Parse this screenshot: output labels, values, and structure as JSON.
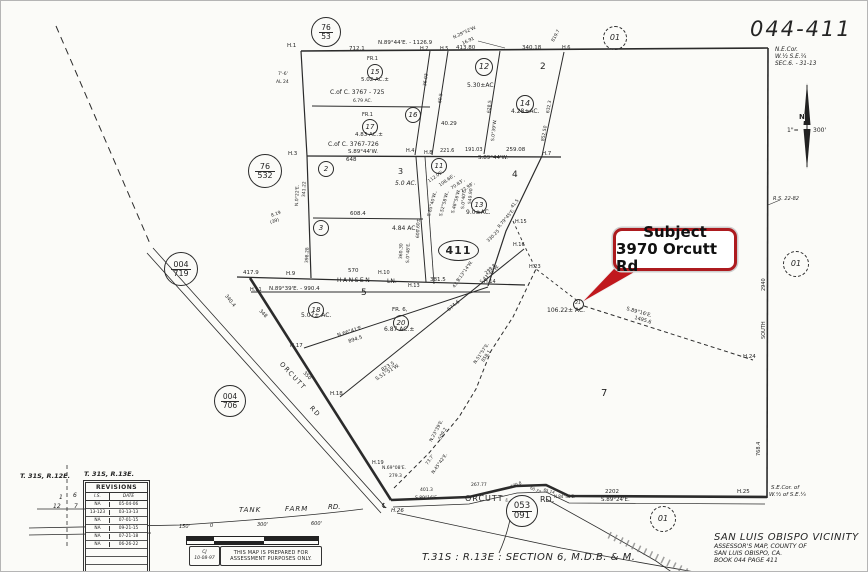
{
  "sheet": {
    "number": "044-411",
    "corner_note": [
      "N.E.Cor.",
      "W.½ S.E.¼",
      "SEC.6. - 31-13"
    ]
  },
  "callout": {
    "title": "Subject",
    "address": "3970 Orcutt Rd",
    "red": "#ad1b1f"
  },
  "index_oval": "411",
  "township": {
    "left": "T. 31S, R.12E.",
    "right": "T. 31S, R.13E."
  },
  "revisions": {
    "title": "REVISIONS",
    "columns": [
      "I.S.",
      "DATE"
    ],
    "rows": [
      [
        "NA",
        "05-04-06"
      ],
      [
        "13-123",
        "03-13-13"
      ],
      [
        "NA",
        "07-01-15"
      ],
      [
        "NA",
        "09-21-15"
      ],
      [
        "NA",
        "07-21-18"
      ],
      [
        "NA",
        "06-26-22"
      ]
    ],
    "empty_rows": 4
  },
  "scalebar": {
    "ticks": [
      "150'",
      "0",
      "300'",
      "600'"
    ]
  },
  "stamp": {
    "initials": "CJ",
    "date": "10-08-97",
    "line1": "THIS MAP IS PREPARED FOR",
    "line2": "ASSESSMENT PURPOSES ONLY."
  },
  "footer": {
    "section": "T.31S : R.13E : SECTION  6, M.D.B. & M.",
    "vicinity": "SAN LUIS OBISPO VICINITY",
    "sub1": "ASSESSOR'S MAP, COUNTY OF",
    "sub2": "SAN LUIS OBISPO, CA.",
    "sub3": "BOOK 044 PAGE 411"
  },
  "ref_circles": [
    {
      "a": "76",
      "b": "53",
      "x": 325,
      "y": 31,
      "d": 30,
      "f": 7.5
    },
    {
      "a": "76",
      "b": "532",
      "x": 264,
      "y": 170,
      "d": 34,
      "f": 8
    },
    {
      "a": "004",
      "b": "719",
      "x": 180,
      "y": 268,
      "d": 34,
      "f": 8
    },
    {
      "a": "004",
      "b": "706",
      "x": 229,
      "y": 400,
      "d": 32,
      "f": 7.5
    },
    {
      "a": "053",
      "b": "091",
      "x": 521,
      "y": 510,
      "d": 32,
      "f": 8.5,
      "fill": true
    },
    {
      "a": "01",
      "x": 614,
      "y": 37,
      "d": 24,
      "f": 8,
      "dash": true
    },
    {
      "a": "01",
      "x": 795,
      "y": 263,
      "d": 26,
      "f": 8,
      "dash": true
    },
    {
      "a": "01",
      "x": 662,
      "y": 518,
      "d": 26,
      "f": 8,
      "dash": true
    }
  ],
  "parcel_circles": [
    {
      "n": "15",
      "x": 374,
      "y": 71
    },
    {
      "n": "17",
      "x": 369,
      "y": 126
    },
    {
      "n": "16",
      "x": 412,
      "y": 114
    },
    {
      "n": "12",
      "x": 483,
      "y": 66,
      "d": 18,
      "f": 8
    },
    {
      "n": "14",
      "x": 524,
      "y": 103,
      "d": 18,
      "f": 8
    },
    {
      "n": "2",
      "x": 325,
      "y": 168
    },
    {
      "n": "3",
      "x": 320,
      "y": 227
    },
    {
      "n": "11",
      "x": 438,
      "y": 165
    },
    {
      "n": "13",
      "x": 478,
      "y": 204
    },
    {
      "n": "18",
      "x": 315,
      "y": 309
    },
    {
      "n": "20",
      "x": 400,
      "y": 322
    },
    {
      "n": "21",
      "x": 577,
      "y": 303,
      "d": 11,
      "f": 4.5
    }
  ],
  "map_labels": [
    {
      "t": "H.1",
      "x": 286,
      "y": 43,
      "s": 5.5
    },
    {
      "t": "712.1",
      "x": 348,
      "y": 46,
      "s": 5.5
    },
    {
      "t": "N.89°44'E. - 1126.9",
      "x": 377,
      "y": 40,
      "s": 5.5
    },
    {
      "t": "H.2",
      "x": 419,
      "y": 46,
      "s": 5
    },
    {
      "t": "H.5",
      "x": 439,
      "y": 46,
      "s": 5
    },
    {
      "t": "413.80",
      "x": 455,
      "y": 45,
      "s": 5.5
    },
    {
      "t": "340.18",
      "x": 521,
      "y": 45,
      "s": 5.5
    },
    {
      "t": "H.6",
      "x": 561,
      "y": 45,
      "s": 5
    },
    {
      "t": "N.29°52'W.",
      "x": 452,
      "y": 36,
      "r": -25,
      "s": 4.5
    },
    {
      "t": "16.91",
      "x": 461,
      "y": 42,
      "r": -25,
      "s": 4.5
    },
    {
      "t": "819.7",
      "x": 551,
      "y": 40,
      "r": -62,
      "s": 4.5
    },
    {
      "t": "7'-6'",
      "x": 277,
      "y": 72,
      "s": 4.5
    },
    {
      "t": "AL 24",
      "x": 275,
      "y": 80,
      "s": 4.5
    },
    {
      "t": "FR.1",
      "x": 366,
      "y": 56,
      "s": 5
    },
    {
      "t": "5.02 AC.±",
      "x": 360,
      "y": 77,
      "s": 5.5
    },
    {
      "t": "C.of C. 3767 - 725",
      "x": 329,
      "y": 89,
      "s": 6
    },
    {
      "t": "6.79 AC.",
      "x": 352,
      "y": 99,
      "s": 4.5
    },
    {
      "t": "FR.1",
      "x": 361,
      "y": 112,
      "s": 5
    },
    {
      "t": "4.83 AC.±",
      "x": 354,
      "y": 132,
      "s": 5.5
    },
    {
      "t": "C.of C. 3767-726",
      "x": 327,
      "y": 141,
      "s": 6
    },
    {
      "t": "S.89°44'W.",
      "x": 347,
      "y": 149,
      "s": 5.5
    },
    {
      "t": "648",
      "x": 345,
      "y": 157,
      "s": 5.5
    },
    {
      "t": "36.03",
      "x": 423,
      "y": 85,
      "r": -82,
      "s": 4.5
    },
    {
      "t": "60.5",
      "x": 438,
      "y": 102,
      "r": -82,
      "s": 4.5
    },
    {
      "t": "40.29",
      "x": 440,
      "y": 121,
      "s": 5.5
    },
    {
      "t": "5.30±AC.",
      "x": 466,
      "y": 82,
      "s": 6
    },
    {
      "t": "2",
      "x": 539,
      "y": 62,
      "s": 9
    },
    {
      "t": "4.28±AC.",
      "x": 510,
      "y": 108,
      "s": 6
    },
    {
      "t": "628.5",
      "x": 487,
      "y": 112,
      "r": -84,
      "s": 4.5
    },
    {
      "t": "S.0°39'W.",
      "x": 491,
      "y": 140,
      "r": -84,
      "s": 4.5
    },
    {
      "t": "632.3",
      "x": 546,
      "y": 112,
      "r": -80,
      "s": 4.5
    },
    {
      "t": "852.50",
      "x": 541,
      "y": 140,
      "r": -80,
      "s": 4.5
    },
    {
      "t": "H.3",
      "x": 287,
      "y": 151,
      "s": 5.5
    },
    {
      "t": "H.4",
      "x": 405,
      "y": 148,
      "s": 5
    },
    {
      "t": "H.8",
      "x": 423,
      "y": 150,
      "s": 5
    },
    {
      "t": "221.6",
      "x": 439,
      "y": 148,
      "s": 5
    },
    {
      "t": "191.03",
      "x": 464,
      "y": 147,
      "s": 5
    },
    {
      "t": "259.08",
      "x": 505,
      "y": 147,
      "s": 5.5
    },
    {
      "t": "H.7",
      "x": 541,
      "y": 151,
      "s": 5.5
    },
    {
      "t": "S.89°44'W.",
      "x": 477,
      "y": 155,
      "s": 5.5
    },
    {
      "t": "3",
      "x": 397,
      "y": 167,
      "s": 8
    },
    {
      "t": "5.0 AC.",
      "x": 394,
      "y": 180,
      "s": 6,
      "i": 1
    },
    {
      "t": "608.4",
      "x": 349,
      "y": 211,
      "s": 5.5
    },
    {
      "t": "4.84 AC.",
      "x": 391,
      "y": 225,
      "s": 6
    },
    {
      "t": "N.0°22'E.",
      "x": 295,
      "y": 205,
      "r": -88,
      "s": 4.5
    },
    {
      "t": "341.22",
      "x": 302,
      "y": 196,
      "r": -88,
      "s": 4.5
    },
    {
      "t": "398.28",
      "x": 305,
      "y": 262,
      "r": -88,
      "s": 4.5
    },
    {
      "t": "112.05',",
      "x": 427,
      "y": 180,
      "r": -35,
      "s": 4.5
    },
    {
      "t": "108.66',",
      "x": 438,
      "y": 184,
      "r": -35,
      "s": 4.5
    },
    {
      "t": "70.83',",
      "x": 450,
      "y": 187,
      "r": -35,
      "s": 4.5
    },
    {
      "t": "72.98',",
      "x": 460,
      "y": 190,
      "r": -35,
      "s": 4.5
    },
    {
      "t": "S.85°40'W.,",
      "x": 427,
      "y": 215,
      "r": -75,
      "s": 4.5
    },
    {
      "t": "S.52°58'W.,",
      "x": 439,
      "y": 215,
      "r": -75,
      "s": 4.5
    },
    {
      "t": "S.48°56'W.",
      "x": 451,
      "y": 212,
      "r": -75,
      "s": 4.5
    },
    {
      "t": "S.0°40'E.",
      "x": 461,
      "y": 208,
      "r": -85,
      "s": 4.5
    },
    {
      "t": "549.90",
      "x": 468,
      "y": 203,
      "r": -85,
      "s": 4.5
    },
    {
      "t": "600.60±",
      "x": 416,
      "y": 237,
      "r": -88,
      "s": 4.5
    },
    {
      "t": "360.30",
      "x": 399,
      "y": 258,
      "r": -88,
      "s": 4.5
    },
    {
      "t": "S.0°48'E.",
      "x": 406,
      "y": 262,
      "r": -88,
      "s": 4.5
    },
    {
      "t": "9.0±AC.",
      "x": 465,
      "y": 209,
      "s": 6
    },
    {
      "t": "4",
      "x": 511,
      "y": 170,
      "s": 9
    },
    {
      "t": "41.5",
      "x": 510,
      "y": 206,
      "r": -50,
      "s": 4.5
    },
    {
      "t": "R.79°45'E.",
      "x": 497,
      "y": 226,
      "r": -50,
      "s": 4.5
    },
    {
      "t": "330.25",
      "x": 486,
      "y": 240,
      "r": -45,
      "s": 4.5
    },
    {
      "t": "S.13°14'W.",
      "x": 456,
      "y": 280,
      "r": -55,
      "s": 4.5
    },
    {
      "t": "43.7'",
      "x": 452,
      "y": 286,
      "r": -55,
      "s": 4.5
    },
    {
      "t": "299.8",
      "x": 484,
      "y": 272,
      "r": -43,
      "s": 4.5
    },
    {
      "t": "S.43°49'W.",
      "x": 479,
      "y": 281,
      "r": -43,
      "s": 4.5
    },
    {
      "t": "H.15",
      "x": 514,
      "y": 219,
      "s": 5
    },
    {
      "t": "H.16",
      "x": 512,
      "y": 242,
      "s": 5
    },
    {
      "t": "H.23",
      "x": 528,
      "y": 264,
      "s": 5
    },
    {
      "t": "417.9",
      "x": 242,
      "y": 270,
      "s": 5.5
    },
    {
      "t": "H.9",
      "x": 285,
      "y": 271,
      "s": 5.5
    },
    {
      "t": "570",
      "x": 347,
      "y": 268,
      "s": 5.5
    },
    {
      "t": "H.10",
      "x": 377,
      "y": 270,
      "s": 5
    },
    {
      "t": "HANSEN",
      "x": 336,
      "y": 277,
      "s": 6,
      "sp": 1.5
    },
    {
      "t": "LN.",
      "x": 386,
      "y": 278,
      "s": 6
    },
    {
      "t": "381.5",
      "x": 429,
      "y": 277,
      "s": 5.5
    },
    {
      "t": "H.14",
      "x": 483,
      "y": 279,
      "s": 5
    },
    {
      "t": "H.13",
      "x": 407,
      "y": 283,
      "s": 5
    },
    {
      "t": "N.89°39'E. - 990.4",
      "x": 268,
      "y": 286,
      "s": 5.5
    },
    {
      "t": "H.11",
      "x": 249,
      "y": 287,
      "s": 5
    },
    {
      "t": "5",
      "x": 360,
      "y": 288,
      "s": 9
    },
    {
      "t": "5.07± AC.",
      "x": 300,
      "y": 312,
      "s": 6
    },
    {
      "t": "FR. 6,",
      "x": 391,
      "y": 307,
      "s": 5.5
    },
    {
      "t": "6.87 AC.±",
      "x": 383,
      "y": 326,
      "s": 6
    },
    {
      "t": "N.66°41'E.",
      "x": 336,
      "y": 333,
      "r": -18,
      "s": 5
    },
    {
      "t": "894.5",
      "x": 347,
      "y": 339,
      "r": -18,
      "s": 5
    },
    {
      "t": "823.5",
      "x": 380,
      "y": 368,
      "r": -32,
      "s": 5
    },
    {
      "t": "S.51°51'W.",
      "x": 374,
      "y": 377,
      "r": -32,
      "s": 5
    },
    {
      "t": "674.6",
      "x": 446,
      "y": 308,
      "r": -40,
      "s": 5
    },
    {
      "t": "H.17",
      "x": 289,
      "y": 343,
      "s": 5.5
    },
    {
      "t": "H.18",
      "x": 329,
      "y": 391,
      "s": 5.5
    },
    {
      "t": "350",
      "x": 304,
      "y": 370,
      "r": 46,
      "s": 5
    },
    {
      "t": "348",
      "x": 260,
      "y": 308,
      "r": 46,
      "s": 5
    },
    {
      "t": "340.4",
      "x": 226,
      "y": 293,
      "r": 52,
      "s": 5
    },
    {
      "t": "ORCUTT",
      "x": 282,
      "y": 360,
      "r": 47,
      "s": 6.5,
      "sp": 1.5
    },
    {
      "t": "RD",
      "x": 312,
      "y": 404,
      "r": 47,
      "s": 6.5,
      "sp": 1.5
    },
    {
      "t": "106.22± AC.",
      "x": 546,
      "y": 307,
      "s": 6
    },
    {
      "t": "S.89°16'E.",
      "x": 626,
      "y": 306,
      "r": 16,
      "s": 5
    },
    {
      "t": "1495.6",
      "x": 634,
      "y": 315,
      "r": 16,
      "s": 5
    },
    {
      "t": "H.24",
      "x": 742,
      "y": 354,
      "s": 5.5
    },
    {
      "t": "7",
      "x": 600,
      "y": 388,
      "s": 10
    },
    {
      "t": "2940",
      "x": 761,
      "y": 290,
      "r": -90,
      "s": 5
    },
    {
      "t": "SOUTH",
      "x": 761,
      "y": 338,
      "r": -90,
      "s": 5
    },
    {
      "t": "768.4",
      "x": 756,
      "y": 455,
      "r": -90,
      "s": 5
    },
    {
      "t": "H.25",
      "x": 736,
      "y": 489,
      "s": 5.5
    },
    {
      "t": "S.E.Cor. of",
      "x": 770,
      "y": 485,
      "s": 5.5,
      "i": 1
    },
    {
      "t": "W.½ of S.E.¼",
      "x": 768,
      "y": 492,
      "s": 5.5,
      "i": 1
    },
    {
      "t": "R.S. 22-82",
      "x": 772,
      "y": 196,
      "s": 5,
      "i": 1
    },
    {
      "t": "73.7'",
      "x": 425,
      "y": 463,
      "r": -55,
      "s": 4.5
    },
    {
      "t": "N.45°42'E.",
      "x": 431,
      "y": 472,
      "r": -55,
      "s": 4.5
    },
    {
      "t": "N.23°39'E.",
      "x": 429,
      "y": 440,
      "r": -62,
      "s": 4.5
    },
    {
      "t": "509.2",
      "x": 438,
      "y": 438,
      "r": -62,
      "s": 4.5
    },
    {
      "t": "N.51°57'E.",
      "x": 473,
      "y": 362,
      "r": -56,
      "s": 4.5
    },
    {
      "t": "858.1",
      "x": 481,
      "y": 360,
      "r": -56,
      "s": 4.5
    },
    {
      "t": "H.19",
      "x": 371,
      "y": 460,
      "s": 5
    },
    {
      "t": "N.69°08'E.",
      "x": 381,
      "y": 466,
      "s": 4.5
    },
    {
      "t": "279.3",
      "x": 388,
      "y": 474,
      "s": 4.5
    },
    {
      "t": "401.3",
      "x": 419,
      "y": 488,
      "s": 4.5
    },
    {
      "t": "S.89°16'E.",
      "x": 414,
      "y": 496,
      "s": 4.5
    },
    {
      "t": "267.77",
      "x": 470,
      "y": 483,
      "s": 4.5
    },
    {
      "t": "170.8",
      "x": 509,
      "y": 484,
      "r": -20,
      "s": 4
    },
    {
      "t": "S.44°11'E.",
      "x": 505,
      "y": 497,
      "r": 25,
      "s": 4
    },
    {
      "t": "60.77",
      "x": 530,
      "y": 485,
      "r": 25,
      "s": 4
    },
    {
      "t": "65.14",
      "x": 543,
      "y": 487,
      "r": 15,
      "s": 4
    },
    {
      "t": "N.84°46'E.",
      "x": 553,
      "y": 494,
      "s": 4
    },
    {
      "t": "2202",
      "x": 604,
      "y": 489,
      "s": 5.5
    },
    {
      "t": "S.89°24'E.",
      "x": 600,
      "y": 497,
      "s": 5.5
    },
    {
      "t": "ORCUTT",
      "x": 464,
      "y": 494,
      "s": 8,
      "sp": 1
    },
    {
      "t": "RD.",
      "x": 539,
      "y": 495,
      "s": 8
    },
    {
      "t": "℄",
      "x": 381,
      "y": 502,
      "s": 7
    },
    {
      "t": "H.26",
      "x": 390,
      "y": 508,
      "s": 5.5,
      "i": 1
    },
    {
      "t": "TANK",
      "x": 238,
      "y": 506,
      "s": 7,
      "i": 1,
      "sp": 1
    },
    {
      "t": "FARM",
      "x": 284,
      "y": 505,
      "s": 7,
      "i": 1,
      "sp": 1
    },
    {
      "t": "RD.",
      "x": 327,
      "y": 503,
      "s": 7,
      "i": 1
    },
    {
      "t": "8.19",
      "x": 270,
      "y": 214,
      "r": -20,
      "s": 4.5
    },
    {
      "t": "(39)",
      "x": 269,
      "y": 221,
      "r": -20,
      "s": 4.5
    },
    {
      "t": "N",
      "x": 798,
      "y": 113,
      "s": 7,
      "b": 1,
      "bg": 1
    },
    {
      "t": "1\"=",
      "x": 786,
      "y": 127,
      "s": 6
    },
    {
      "t": "300'",
      "x": 812,
      "y": 127,
      "s": 6
    },
    {
      "t": "1",
      "x": 58,
      "y": 494,
      "s": 6,
      "i": 1
    },
    {
      "t": "12",
      "x": 52,
      "y": 503,
      "s": 6,
      "i": 1
    },
    {
      "t": "6",
      "x": 72,
      "y": 492,
      "s": 6,
      "i": 1
    },
    {
      "t": "7",
      "x": 73,
      "y": 503,
      "s": 6,
      "i": 1
    }
  ]
}
